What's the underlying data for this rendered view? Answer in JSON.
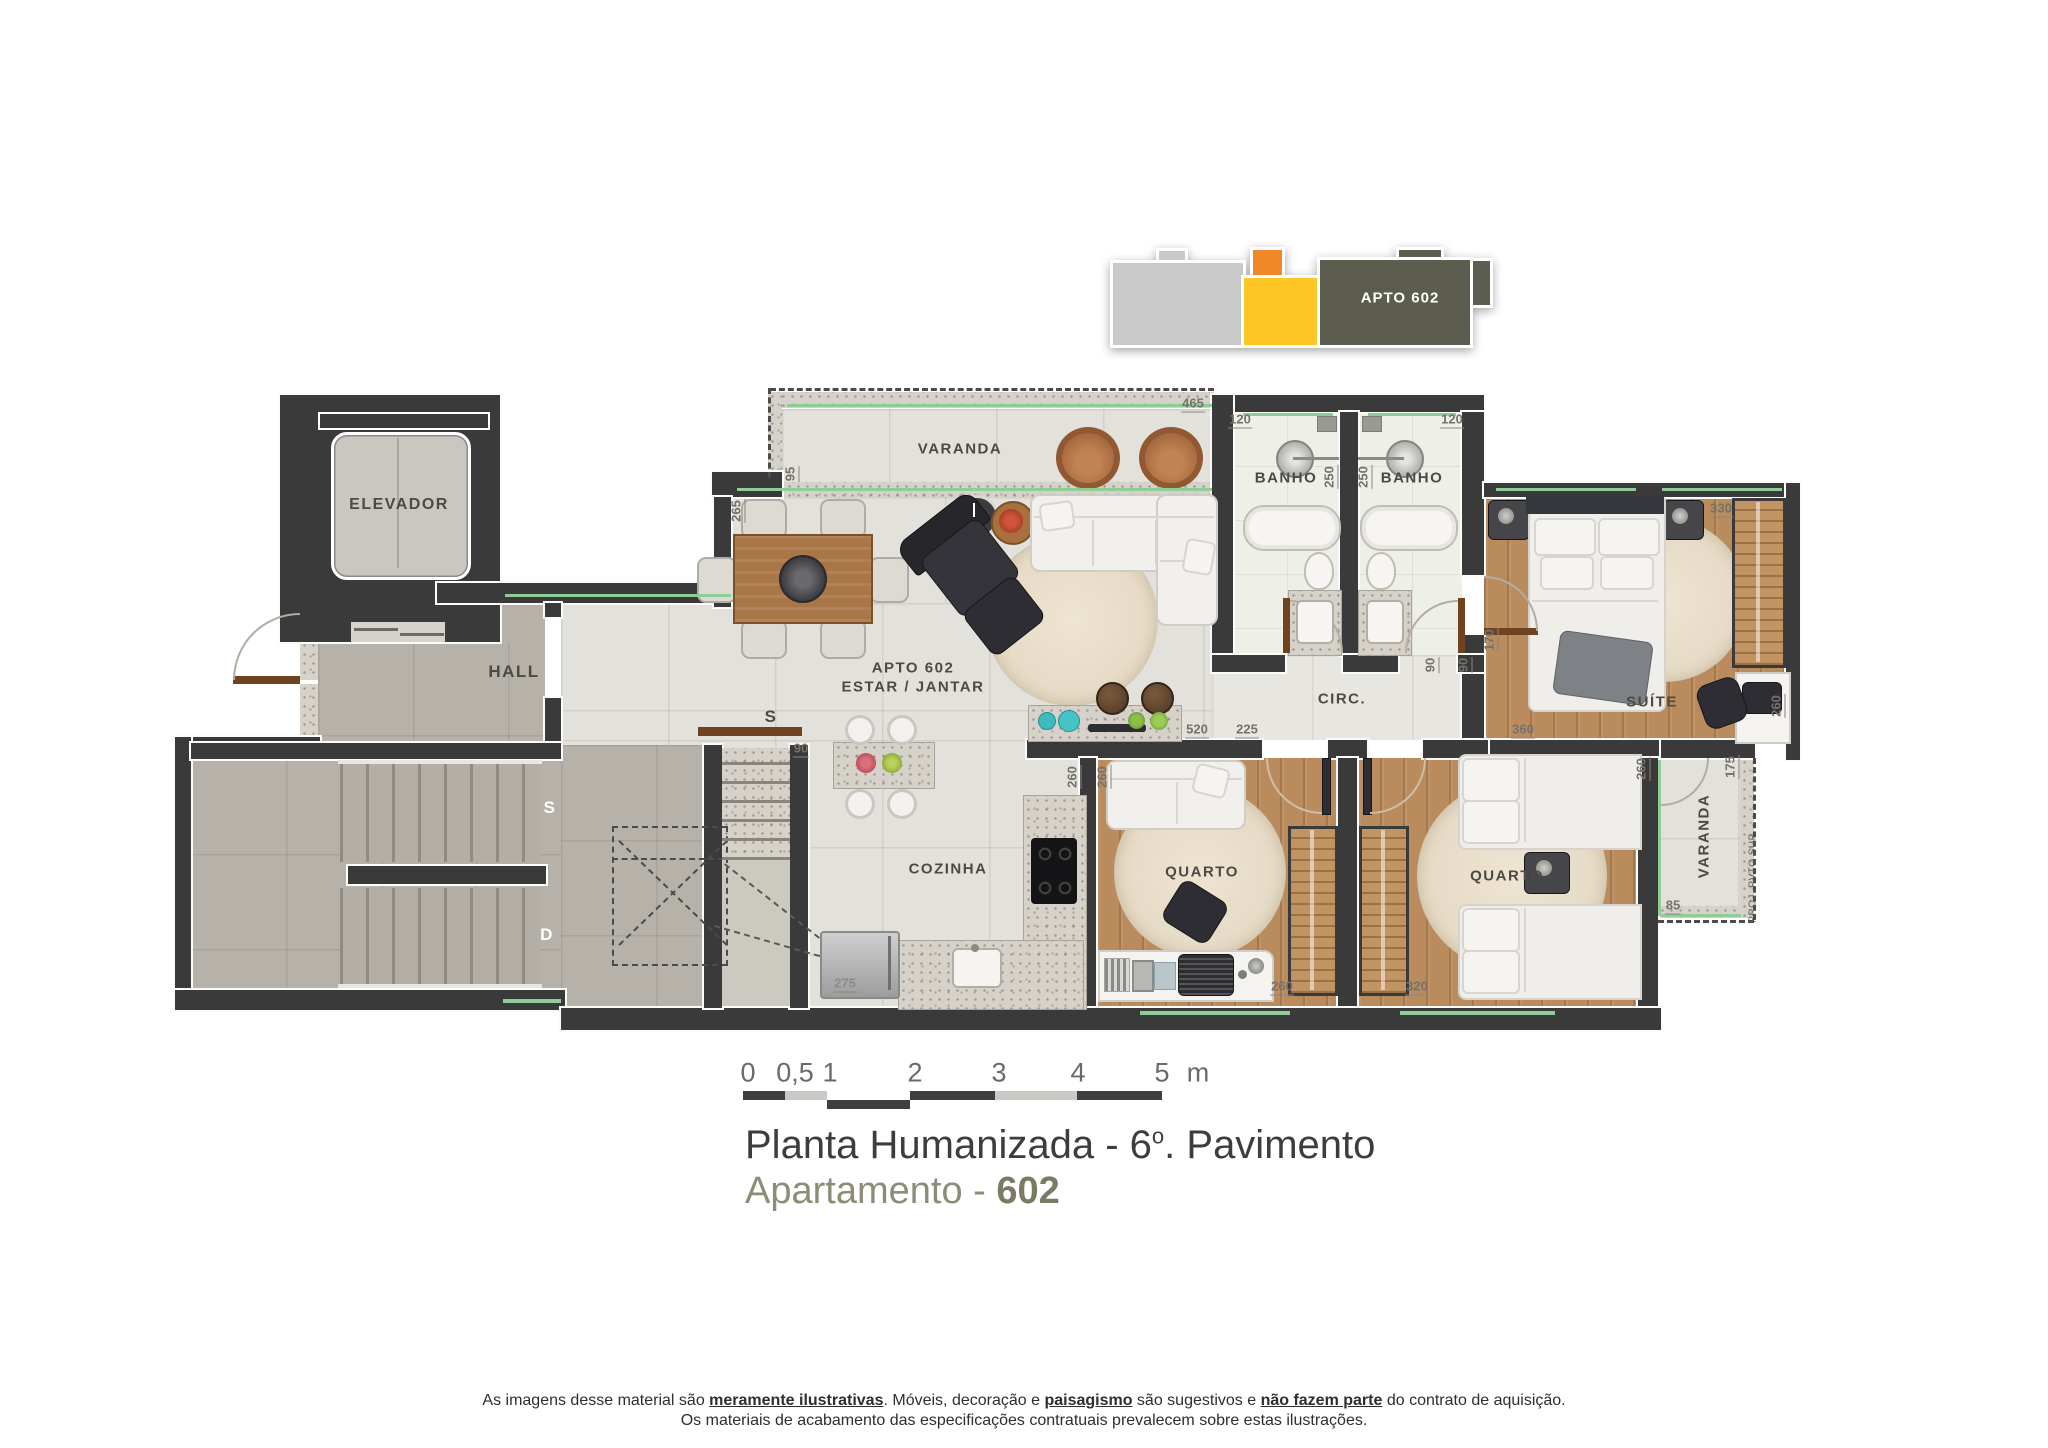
{
  "keyplan": {
    "label": "APTO 602",
    "colors": {
      "gray": "#c9c9c9",
      "orange": "#f0882a",
      "yellow": "#ffc725",
      "olive": "#5d5d4f"
    }
  },
  "rooms": {
    "elevador": "ELEVADOR",
    "hall": "HALL",
    "varanda": "VARANDA",
    "banho": "BANHO",
    "apto_line1": "APTO 602",
    "apto_line2": "ESTAR / JANTAR",
    "circ": "CIRC.",
    "suite": "SUÍTE",
    "cozinha": "COZINHA",
    "quarto": "QUARTO",
    "varanda2": "VARANDA",
    "proj_sup": "PROJ. PVTO SUP.",
    "stair_s": "S",
    "stair_d": "D",
    "stair_s2": "S"
  },
  "dims": {
    "d465": "465",
    "d120a": "120",
    "d120b": "120",
    "d250a": "250",
    "d250b": "250",
    "d95": "95",
    "d265": "265",
    "d330": "330",
    "d170": "170",
    "d90a": "90",
    "d90b": "90",
    "d520": "520",
    "d225": "225",
    "d360": "360",
    "d260s": "260",
    "d175": "175",
    "d85": "85",
    "d260a": "260",
    "d260b": "260",
    "d260c": "260",
    "d320": "320",
    "d260d": "260",
    "d275": "275",
    "d90c": "90"
  },
  "scalebar": {
    "t0": "0",
    "t05": "0,5",
    "t1": "1",
    "t2": "2",
    "t3": "3",
    "t4": "4",
    "t5": "5",
    "unit": "m"
  },
  "title": {
    "part1": "Planta Humanizada - 6",
    "sup": "o",
    "part2": ". Pavimento",
    "sub_label": "Apartamento - ",
    "sub_num": "602"
  },
  "disclaimer": {
    "p1": "As imagens desse material são ",
    "b1": "meramente ilustrativas",
    "p2": ". Móveis, decoração e ",
    "b2": "paisagismo",
    "p3": " são sugestivos e ",
    "b3": "não fazem parte",
    "p4": " do contrato de aquisição.",
    "line2": "Os materiais de acabamento das especificações contratuais prevalecem sobre estas ilustrações."
  }
}
